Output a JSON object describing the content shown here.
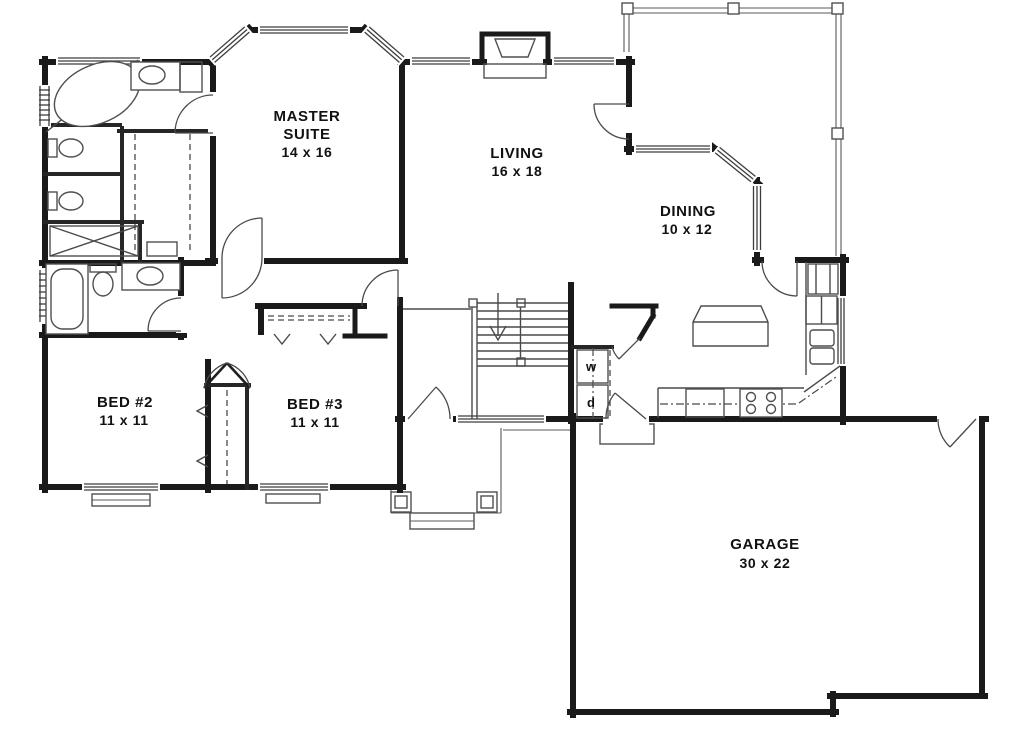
{
  "document": {
    "type": "floor-plan",
    "background": "#ffffff"
  },
  "colors": {
    "wall": "#1a1a1a",
    "medium_line": "#262626",
    "thin_line": "#4a4a4a",
    "text": "#111111"
  },
  "rooms": {
    "master": {
      "line1": "MASTER",
      "line2": "SUITE",
      "dims": "14 x 16"
    },
    "living": {
      "line1": "LIVING",
      "dims": "16 x 18"
    },
    "dining": {
      "line1": "DINING",
      "dims": "10 x 12"
    },
    "bed2": {
      "line1": "BED #2",
      "dims": "11 x 11"
    },
    "bed3": {
      "line1": "BED #3",
      "dims": "11 x 11"
    },
    "garage": {
      "line1": "GARAGE",
      "dims": "30 x 22"
    }
  },
  "laundry": {
    "washer": "w",
    "dryer": "d"
  },
  "fixtures": [
    "corner-tub",
    "toilet",
    "vanity-sink",
    "walk-in-closet",
    "linen-closet",
    "bathtub",
    "fireplace",
    "staircase-down",
    "kitchen-island",
    "range-stove",
    "dishwasher",
    "refrigerator",
    "pantry",
    "double-sink",
    "washer-dryer-closet",
    "deck",
    "covered-porch",
    "garage-stoop",
    "front-door",
    "bay-window"
  ]
}
